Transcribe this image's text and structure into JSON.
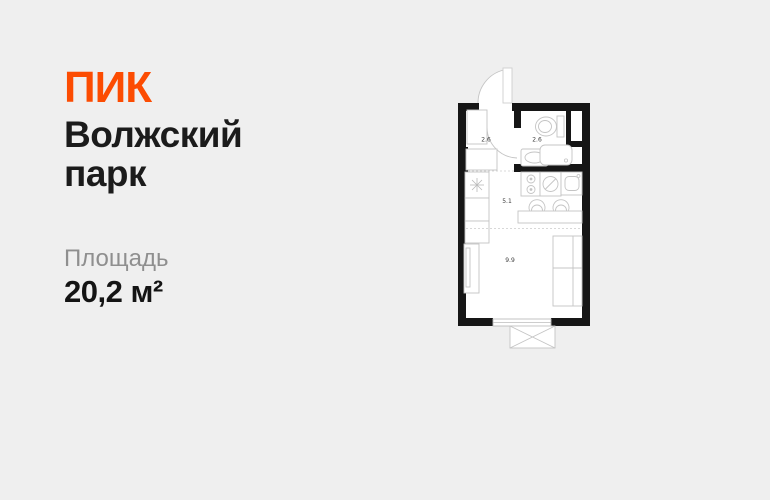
{
  "page": {
    "background": "#efefef"
  },
  "brand": {
    "logo_text": "ПИК",
    "color": "#fc4c02"
  },
  "project": {
    "name": "Волжский парк"
  },
  "area": {
    "label": "Площадь",
    "value": "20,2 м²"
  },
  "floorplan": {
    "rooms": [
      {
        "id": "hallway",
        "area_label": "2.6"
      },
      {
        "id": "bathroom",
        "area_label": "2.6"
      },
      {
        "id": "kitchen",
        "area_label": "5.1"
      },
      {
        "id": "living-room",
        "area_label": "9.9"
      }
    ],
    "colors": {
      "wall": "#161616",
      "floor": "#ffffff",
      "furniture_stroke": "#c4c4c4",
      "room_label": "#3d3d3d"
    }
  }
}
